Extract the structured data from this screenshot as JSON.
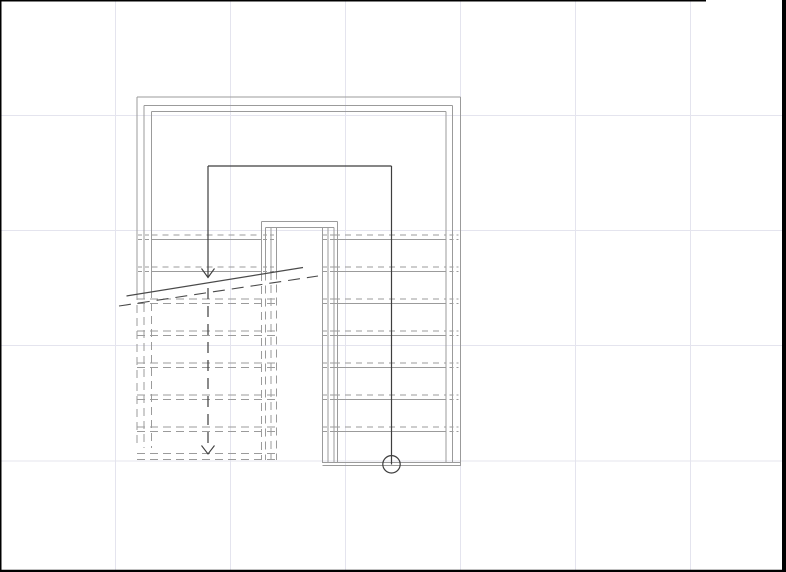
{
  "canvas": {
    "width": 786,
    "height": 572,
    "background": "#ffffff"
  },
  "colors": {
    "line": "#9b9b9b",
    "dark": "#3e3e3e",
    "break": "#4a4a4a",
    "grid": "#e4e4ee",
    "border": "#000000"
  },
  "grid": {
    "vertical_x": [
      115.5,
      230.5,
      345.5,
      460.5,
      575.5,
      690.5
    ],
    "horizontal_y": [
      115.5,
      230.5,
      345.5,
      461
    ]
  },
  "border_segments": [
    {
      "x1": 0.75,
      "y1": 0,
      "x2": 0.75,
      "y2": 572,
      "w": 1.5
    },
    {
      "x1": 0,
      "y1": 0.75,
      "x2": 706,
      "y2": 0.75,
      "w": 1.5
    },
    {
      "x1": 784,
      "y1": 0,
      "x2": 784,
      "y2": 572,
      "w": 4
    },
    {
      "x1": 0,
      "y1": 570.9,
      "x2": 786,
      "y2": 570.9,
      "w": 2.2
    }
  ],
  "shaft": {
    "top_lines": [
      [
        137,
        97,
        460.5
      ],
      [
        144,
        105.5,
        452.5
      ],
      [
        151.5,
        111.5,
        446
      ]
    ],
    "right_walls": [
      [
        460.5,
        97,
        466
      ],
      [
        452.5,
        105.5,
        463
      ],
      [
        446,
        111.5,
        463
      ]
    ],
    "left_walls_solid": [
      [
        137,
        97,
        292
      ],
      [
        144,
        105.5,
        291
      ],
      [
        151.5,
        111.5,
        290
      ]
    ],
    "left_walls_hidden": [
      [
        137,
        292,
        448
      ],
      [
        144,
        291,
        448
      ],
      [
        151.5,
        290,
        448
      ]
    ]
  },
  "well": {
    "top_lines": [
      [
        261.5,
        221.5,
        337.5
      ],
      [
        265.5,
        227.5,
        334
      ]
    ],
    "right_verticals": [
      [
        337.5,
        221.5,
        463
      ],
      [
        334,
        227.5,
        463
      ],
      [
        328,
        227.5,
        463
      ],
      [
        322.5,
        227.5,
        463
      ]
    ],
    "left_verticals_solid": [
      [
        261.5,
        221.5,
        273
      ],
      [
        265.5,
        227.5,
        272.5
      ],
      [
        271,
        227.5,
        272
      ],
      [
        276.5,
        227.5,
        271.5
      ]
    ],
    "left_verticals_hidden": [
      [
        261.5,
        273,
        460
      ],
      [
        265.5,
        272.5,
        460
      ],
      [
        271,
        272,
        460
      ],
      [
        276.5,
        271.5,
        460
      ]
    ]
  },
  "right_flight": {
    "tread_y": [
      239.5,
      271.5,
      303.5,
      335.5,
      367.5,
      399.5,
      431.5
    ],
    "tread_span": [
      334,
      446
    ],
    "nosing_offset": 4.5,
    "left_margin": [
      323,
      333.5
    ],
    "right_margin": [
      449.5,
      458.5
    ],
    "bottom_lines_y": [
      462.5,
      465.5
    ],
    "bottom_span": [
      322.5,
      460.5
    ]
  },
  "left_flight": {
    "solid_tread_y": [
      239.5,
      271.5
    ],
    "hidden_tread_y": [
      303.5,
      335.5,
      367.5,
      399.5,
      431.5
    ],
    "tread_span": [
      151.5,
      261.5
    ],
    "hidden_span": [
      137,
      276.5
    ],
    "left_margin": [
      138,
      150.5
    ],
    "right_margin": [
      263,
      275.5
    ],
    "nosing_offset": 4.5,
    "bottom_lines_y": [
      453.5,
      459.5
    ],
    "bottom_span": [
      137,
      276.5
    ]
  },
  "path": {
    "up_line": [
      391.5,
      464.5,
      391.5,
      166
    ],
    "top_line": [
      208,
      166,
      391.5,
      166
    ],
    "down_solid": [
      208,
      166,
      208,
      277.5
    ],
    "arrow1": {
      "tip": [
        208,
        277.5
      ],
      "half_w": 6.5,
      "h": 9
    },
    "down_dashed": [
      208,
      288,
      208,
      445
    ],
    "arrow2": {
      "tip": [
        208,
        454
      ],
      "half_w": 6.5,
      "h": 8.5
    },
    "circle": {
      "cx": 391.5,
      "cy": 464.3,
      "r": 8.7
    }
  },
  "break_mark": {
    "solid": [
      126.5,
      296,
      303,
      267.5
    ],
    "dashed": [
      119,
      306,
      318,
      276
    ]
  },
  "dashes": {
    "hidden": "8 5",
    "nosing": "6 5",
    "margin": "4 3",
    "path": "11 7",
    "break": "12 7"
  }
}
